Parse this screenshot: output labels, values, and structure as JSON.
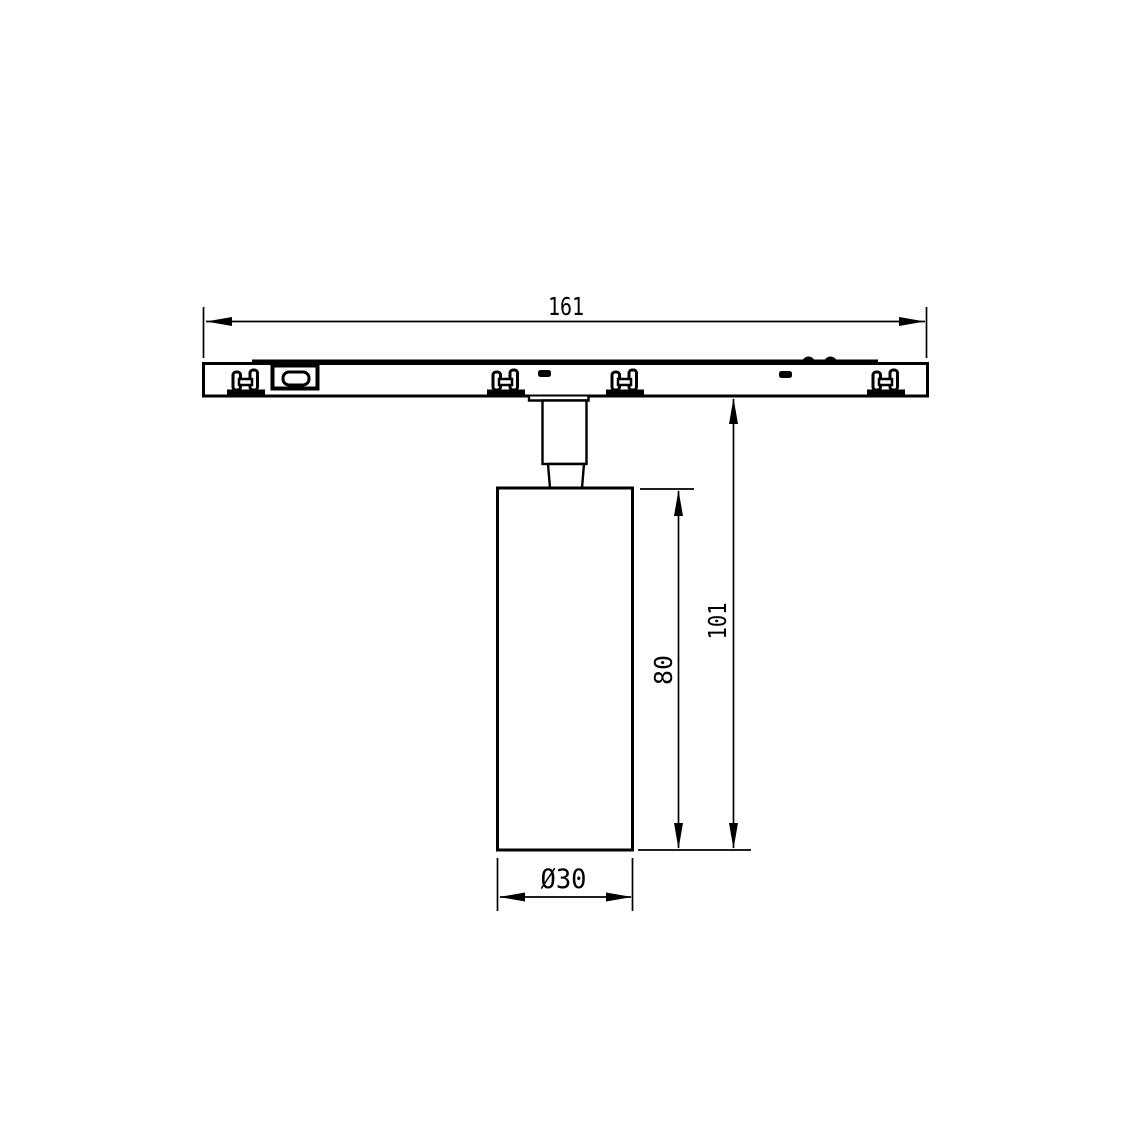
{
  "drawing": {
    "colors": {
      "ink": "#000000",
      "background": "#ffffff"
    },
    "dimensions": {
      "track_length": "161",
      "body_height": "80",
      "overall_height": "101",
      "body_diameter": "Ø30"
    }
  }
}
